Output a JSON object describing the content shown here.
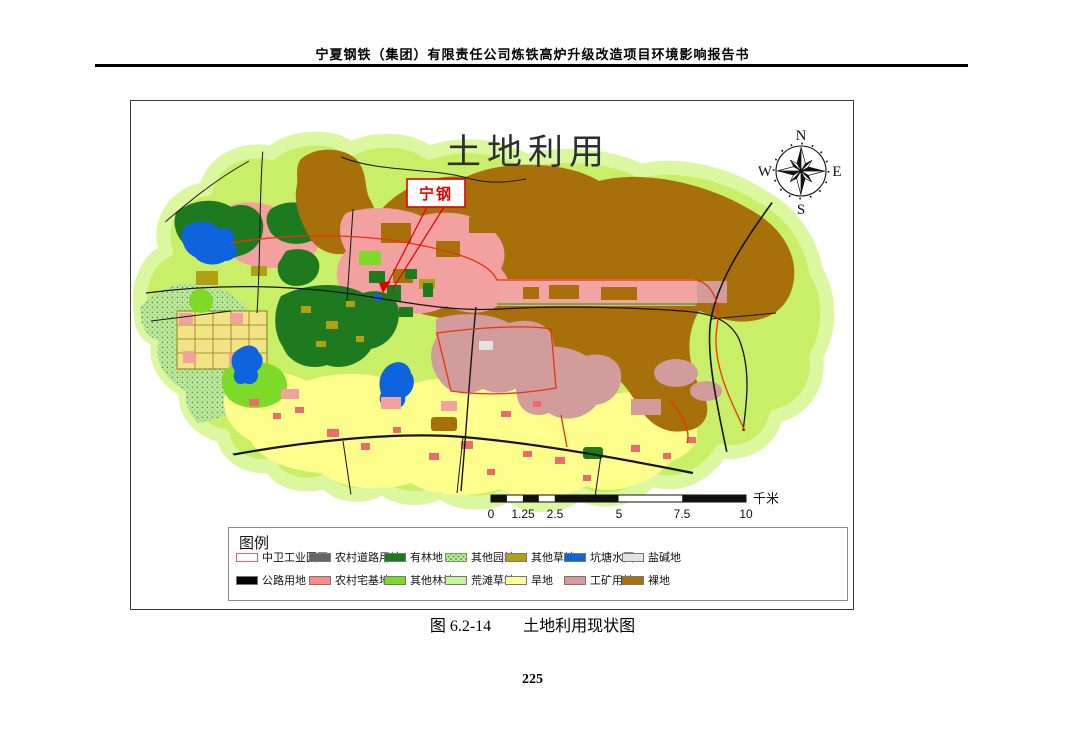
{
  "page": {
    "header": "宁夏钢铁（集团）有限责任公司炼铁高炉升级改造项目环境影响报告书",
    "caption": "图 6.2-14　　土地利用现状图",
    "page_number": "225"
  },
  "map": {
    "title": "土地利用",
    "callout": "宁钢",
    "compass": {
      "n": "N",
      "e": "E",
      "s": "S",
      "w": "W"
    },
    "scalebar": {
      "ticks": [
        "0",
        "1.25",
        "2.5",
        "5",
        "7.5",
        "10"
      ],
      "unit": "千米"
    },
    "palette": {
      "base_green": "#c9ee68",
      "halo_green": "#dbf7a0",
      "bare_brown": "#a8700b",
      "dry_yellow": "#fefe8d",
      "water_blue": "#0d64dc",
      "village_pink": "#f2a0a0",
      "mining_rose": "#d29c9c",
      "boundary_red": "#e8340c"
    }
  },
  "legend": {
    "title": "图例",
    "items": [
      {
        "label": "中卫工业园区",
        "color": "#ffffff",
        "border": "#e06666"
      },
      {
        "label": "农村道路用地",
        "color": "#666666"
      },
      {
        "label": "有林地",
        "color": "#1e7a1e"
      },
      {
        "label": "其他园地",
        "color": "#bee89c",
        "pattern": "green-dots"
      },
      {
        "label": "其他草地",
        "color": "#afa014"
      },
      {
        "label": "坑塘水面",
        "color": "#0d64dc"
      },
      {
        "label": "盐碱地",
        "color": "#e3e3e3"
      },
      {
        "label": "公路用地",
        "color": "#000000"
      },
      {
        "label": "农村宅基地",
        "color": "#f98a8a"
      },
      {
        "label": "其他林地",
        "color": "#7eda28"
      },
      {
        "label": "荒滩草地",
        "color": "#c8f4a2"
      },
      {
        "label": "旱地",
        "color": "#ffff99"
      },
      {
        "label": "工矿用地",
        "color": "#d29c9c"
      },
      {
        "label": "裸地",
        "color": "#a8700b"
      }
    ]
  }
}
